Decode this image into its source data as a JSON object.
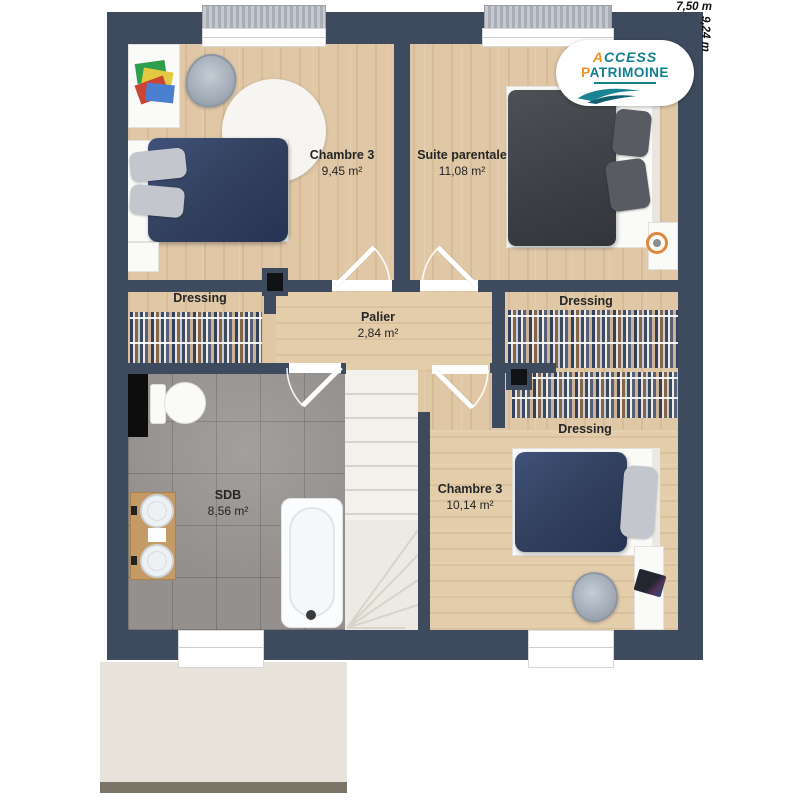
{
  "dimensions": {
    "width_label": "7,50 m",
    "height_label": "9,24 m"
  },
  "logo": {
    "brand_line1": "ACCESS",
    "brand_line2": "PATRIMOINE"
  },
  "rooms": {
    "chambre3_top": {
      "name": "Chambre 3",
      "area": "9,45 m²"
    },
    "suite_parentale": {
      "name": "Suite parentale",
      "area": "11,08 m²"
    },
    "dressing_left": {
      "name": "Dressing"
    },
    "palier": {
      "name": "Palier",
      "area": "2,84 m²"
    },
    "dressing_right_top": {
      "name": "Dressing"
    },
    "dressing_right_bottom": {
      "name": "Dressing"
    },
    "sdb": {
      "name": "SDB",
      "area": "8,56 m²"
    },
    "chambre3_bottom": {
      "name": "Chambre 3",
      "area": "10,14 m²"
    }
  },
  "colors": {
    "wall": "#3e4a5e",
    "wood": "#e0c8a7",
    "tile": "#93908d",
    "stairs": "#f3f1ec",
    "terrace": "#e7e3da",
    "bed_navy": "#33425f",
    "bed_charcoal": "#3c3f44",
    "accent_orange": "#ef9420",
    "accent_teal": "#12808d"
  }
}
